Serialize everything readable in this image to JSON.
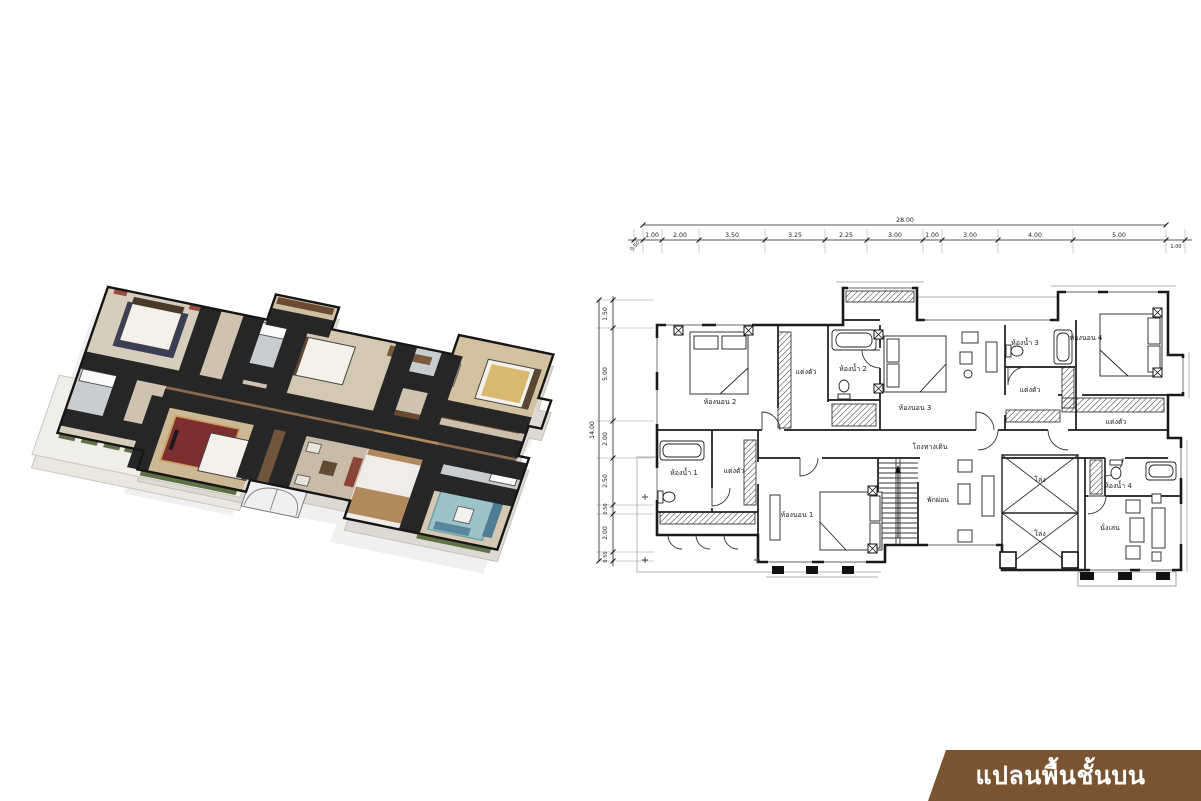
{
  "page": {
    "background": "#ffffff"
  },
  "banner": {
    "label": "แปลนพื้นชั้นบน",
    "background": "#7a5430",
    "text_color": "#ffffff"
  },
  "plan3d": {
    "name": "isometric-3d-floor-plan",
    "colors": {
      "floor_wood": "#8a6a4e",
      "floor_beige": "#d8cdbc",
      "carpet_red": "#7d2f2f",
      "carpet_teal": "#9cc4c8",
      "sofa_blue": "#4e7d95",
      "wardrobe_wood": "#6a4a33",
      "plant_green": "#5e7246",
      "wall_line": "#161616",
      "foundation": "#dedbd5"
    }
  },
  "plan2d": {
    "dimensions": {
      "total_width": "28.00",
      "total_height": "14.00",
      "top_segments": [
        "1.00",
        "2.00",
        "3.50",
        "3.25",
        "2.25",
        "3.00",
        "1.00",
        "3.00",
        "4.00",
        "5.00"
      ],
      "top_left_offset": "0.50",
      "top_right_offset": "1.00",
      "left_segments": [
        "1.50",
        "5.00",
        "2.00",
        "2.50",
        "0.50",
        "2.00",
        "0.50"
      ]
    },
    "rooms": [
      {
        "id": "bedroom-2",
        "label": "ห้องนอน 2"
      },
      {
        "id": "dressing-2",
        "label": "แต่งตัว"
      },
      {
        "id": "bathroom-2",
        "label": "ห้องน้ำ 2"
      },
      {
        "id": "bedroom-3",
        "label": "ห้องนอน 3"
      },
      {
        "id": "bathroom-3",
        "label": "ห้องน้ำ 3"
      },
      {
        "id": "dressing-3",
        "label": "แต่งตัว"
      },
      {
        "id": "bedroom-4",
        "label": "ห้องนอน 4"
      },
      {
        "id": "dressing-4",
        "label": "แต่งตัว"
      },
      {
        "id": "bathroom-4",
        "label": "ห้องน้ำ 4"
      },
      {
        "id": "sitting-room",
        "label": "นั่งเล่น"
      },
      {
        "id": "hallway",
        "label": "โถงทางเดิน"
      },
      {
        "id": "bathroom-1",
        "label": "ห้องน้ำ 1"
      },
      {
        "id": "dressing-1",
        "label": "แต่งตัว"
      },
      {
        "id": "bedroom-1",
        "label": "ห้องนอน 1"
      },
      {
        "id": "lounge",
        "label": "พักผ่อน"
      },
      {
        "id": "void-upper",
        "label": "โล่ง"
      },
      {
        "id": "void-lower",
        "label": "โล่ง"
      }
    ]
  }
}
